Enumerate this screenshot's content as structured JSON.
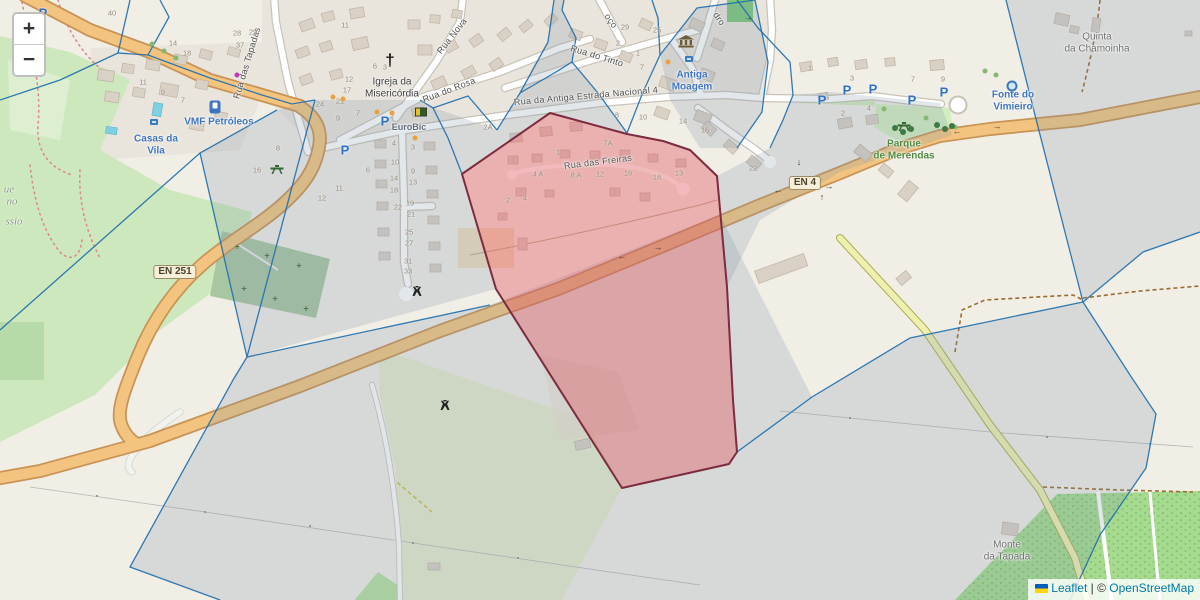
{
  "ui": {
    "zoom_in": "+",
    "zoom_out": "−",
    "attribution": {
      "leaflet": "Leaflet",
      "separator": " | © ",
      "osm": "OpenStreetMap"
    }
  },
  "colors": {
    "parcel_stroke": "#1f6fae",
    "parcel_tint": "rgba(125,145,170,0.22)",
    "highlight_stroke": "#7d2b3e",
    "highlight_fill": "rgba(224,85,95,0.40)",
    "road_primary": "#f3c47f"
  },
  "map": {
    "glyphs": {
      "parking": "P",
      "al": "←",
      "ar": "→",
      "au": "↑",
      "ad": "↓",
      "cross": "†",
      "cem": "+"
    },
    "shields": [
      {
        "t": "EN 251",
        "x": 175,
        "y": 272
      },
      {
        "t": "EN 4",
        "x": 805,
        "y": 183
      }
    ],
    "labels": [
      {
        "t": "Rua das Tapadas",
        "x": 247,
        "y": 63,
        "r": -73,
        "c": "st",
        "n": "street-label-rua-das-tapadas"
      },
      {
        "t": "Rua Nova",
        "x": 452,
        "y": 36,
        "r": -52,
        "c": "st",
        "n": "street-label-rua-nova"
      },
      {
        "t": "Rua do Rosa",
        "x": 449,
        "y": 90,
        "r": -21,
        "c": "st",
        "n": "street-label-rua-do-rosa"
      },
      {
        "t": "Rua do Tinto",
        "x": 597,
        "y": 56,
        "r": 17,
        "c": "st",
        "n": "street-label-rua-do-tinto"
      },
      {
        "t": "Rua da Antiga Estrada Nacional 4",
        "x": 586,
        "y": 96,
        "r": -5,
        "c": "st",
        "n": "street-label-antiga-estrada"
      },
      {
        "t": "Rua das Freiras",
        "x": 598,
        "y": 162,
        "r": -7,
        "c": "st",
        "n": "street-label-rua-das-freiras"
      },
      {
        "t": "oço",
        "x": 611,
        "y": 21,
        "r": 55,
        "c": "st",
        "n": "street-label-partial"
      },
      {
        "t": "dro",
        "x": 719,
        "y": 19,
        "r": 55,
        "c": "st",
        "n": "street-label-partial"
      },
      {
        "t": "VMF Petróleos",
        "x": 219,
        "y": 122,
        "r": 0,
        "c": "poi",
        "n": "poi-label-vmf-petroleos"
      },
      {
        "t": "Casas da\nVila",
        "x": 156,
        "y": 145,
        "r": 0,
        "c": "poi",
        "n": "poi-label-casas-da-vila"
      },
      {
        "t": "Antiga\nMoagem",
        "x": 692,
        "y": 81,
        "r": 0,
        "c": "poi",
        "n": "poi-label-antiga-moagem"
      },
      {
        "t": "Fonte do\nVimieiro",
        "x": 1013,
        "y": 101,
        "r": 0,
        "c": "poi",
        "n": "poi-label-fonte-do-vimieiro"
      },
      {
        "t": "EuroBic",
        "x": 409,
        "y": 127,
        "r": 0,
        "c": "poi2",
        "n": "poi-label-eurobic"
      },
      {
        "t": "Parque\nde Merendas",
        "x": 904,
        "y": 150,
        "r": 0,
        "c": "grn",
        "n": "poi-label-parque-de-merendas"
      },
      {
        "t": "Quinta\nda Chamoinha",
        "x": 1097,
        "y": 43,
        "r": 0,
        "c": "place",
        "n": "place-label-quinta-da-chamoinha"
      },
      {
        "t": "Monte\nda Tapada",
        "x": 1007,
        "y": 551,
        "r": 0,
        "c": "place",
        "n": "place-label-monte-da-tapada"
      },
      {
        "t": "Igreja da\nMisericórdia",
        "x": 392,
        "y": 88,
        "r": 0,
        "c": "dark",
        "n": "poi-label-igreja-misericordia"
      },
      {
        "t": "ue",
        "x": 9,
        "y": 190,
        "r": 0,
        "c": "park",
        "n": "place-label-partial"
      },
      {
        "t": "no",
        "x": 12,
        "y": 202,
        "r": 0,
        "c": "park",
        "n": "place-label-partial"
      },
      {
        "t": "ssio",
        "x": 14,
        "y": 222,
        "r": 0,
        "c": "park",
        "n": "place-label-partial"
      }
    ],
    "housenumbers": [
      [
        112,
        13,
        "40"
      ],
      [
        173,
        43,
        "14"
      ],
      [
        187,
        53,
        "18"
      ],
      [
        143,
        82,
        "11"
      ],
      [
        163,
        92,
        "9"
      ],
      [
        183,
        100,
        "7"
      ],
      [
        345,
        25,
        "11"
      ],
      [
        237,
        33,
        "28"
      ],
      [
        253,
        32,
        "29"
      ],
      [
        240,
        45,
        "37"
      ],
      [
        375,
        66,
        "6"
      ],
      [
        385,
        67,
        "3"
      ],
      [
        349,
        79,
        "12"
      ],
      [
        347,
        90,
        "17"
      ],
      [
        340,
        101,
        "21"
      ],
      [
        320,
        104,
        "24"
      ],
      [
        358,
        113,
        "7"
      ],
      [
        338,
        118,
        "9"
      ],
      [
        278,
        148,
        "8"
      ],
      [
        257,
        170,
        "16"
      ],
      [
        368,
        170,
        "6"
      ],
      [
        339,
        188,
        "11"
      ],
      [
        322,
        198,
        "12"
      ],
      [
        625,
        27,
        "29"
      ],
      [
        657,
        30,
        "25"
      ],
      [
        638,
        53,
        "1"
      ],
      [
        642,
        67,
        "7"
      ],
      [
        618,
        43,
        "2"
      ],
      [
        394,
        143,
        "4"
      ],
      [
        413,
        147,
        "3"
      ],
      [
        395,
        162,
        "10"
      ],
      [
        413,
        171,
        "9"
      ],
      [
        394,
        178,
        "14"
      ],
      [
        413,
        182,
        "13"
      ],
      [
        394,
        190,
        "18"
      ],
      [
        410,
        203,
        "19"
      ],
      [
        398,
        207,
        "22"
      ],
      [
        411,
        214,
        "21"
      ],
      [
        409,
        232,
        "25"
      ],
      [
        409,
        243,
        "27"
      ],
      [
        408,
        261,
        "31"
      ],
      [
        408,
        271,
        "33"
      ],
      [
        488,
        127,
        "2A"
      ],
      [
        608,
        143,
        "7A"
      ],
      [
        558,
        152,
        "1"
      ],
      [
        538,
        174,
        "4 A"
      ],
      [
        576,
        175,
        "8 A"
      ],
      [
        600,
        174,
        "12"
      ],
      [
        628,
        173,
        "16"
      ],
      [
        657,
        177,
        "18"
      ],
      [
        679,
        173,
        "13"
      ],
      [
        508,
        200,
        "2"
      ],
      [
        525,
        198,
        "4"
      ],
      [
        617,
        115,
        "8"
      ],
      [
        643,
        117,
        "10"
      ],
      [
        683,
        121,
        "14"
      ],
      [
        705,
        130,
        "16"
      ],
      [
        753,
        168,
        "22"
      ],
      [
        810,
        68,
        "1"
      ],
      [
        852,
        78,
        "3"
      ],
      [
        913,
        79,
        "7"
      ],
      [
        943,
        79,
        "9"
      ],
      [
        843,
        113,
        "2"
      ],
      [
        869,
        108,
        "4"
      ]
    ],
    "icons": [
      [
        "parking",
        43,
        13
      ],
      [
        "parking",
        345,
        150
      ],
      [
        "parking",
        385,
        121
      ],
      [
        "parking",
        822,
        100
      ],
      [
        "parking",
        847,
        90
      ],
      [
        "parking",
        873,
        89
      ],
      [
        "parking",
        912,
        100
      ],
      [
        "parking",
        944,
        92
      ],
      [
        "fuel",
        215,
        107
      ],
      [
        "museum",
        686,
        44
      ],
      [
        "cross",
        390,
        60
      ],
      [
        "picnic",
        277,
        170
      ],
      [
        "picnic",
        904,
        127
      ],
      [
        "well",
        417,
        292
      ],
      [
        "well",
        445,
        406
      ],
      [
        "fountain",
        1012,
        86
      ],
      [
        "atm",
        421,
        112
      ],
      [
        "shop",
        154,
        122
      ],
      [
        "shop",
        689,
        59
      ],
      [
        "doto",
        333,
        97
      ],
      [
        "doto",
        343,
        99
      ],
      [
        "doto",
        377,
        112
      ],
      [
        "doto",
        392,
        113
      ],
      [
        "doto",
        415,
        138
      ],
      [
        "doto",
        668,
        62
      ],
      [
        "dotm",
        237,
        75
      ],
      [
        "tree",
        152,
        44
      ],
      [
        "tree",
        164,
        51
      ],
      [
        "tree",
        176,
        58
      ],
      [
        "tree",
        985,
        71
      ],
      [
        "tree",
        996,
        75
      ],
      [
        "tree",
        884,
        109
      ],
      [
        "tree",
        926,
        118
      ],
      [
        "tree",
        955,
        127
      ],
      [
        "treed",
        895,
        128
      ],
      [
        "treed",
        903,
        132
      ],
      [
        "treed",
        911,
        129
      ],
      [
        "treed",
        937,
        125
      ],
      [
        "treed",
        945,
        129
      ],
      [
        "treed",
        952,
        126
      ],
      [
        "cem",
        237,
        247
      ],
      [
        "cem",
        267,
        256
      ],
      [
        "cem",
        299,
        266
      ],
      [
        "cem",
        244,
        289
      ],
      [
        "cem",
        275,
        299
      ],
      [
        "cem",
        306,
        309
      ],
      [
        "al",
        622,
        256
      ],
      [
        "ar",
        658,
        247
      ],
      [
        "al",
        778,
        190
      ],
      [
        "ar",
        829,
        186
      ],
      [
        "al",
        957,
        131
      ],
      [
        "ar",
        997,
        126
      ],
      [
        "ar",
        748,
        17
      ],
      [
        "ad",
        799,
        162
      ],
      [
        "au",
        822,
        197
      ]
    ]
  }
}
